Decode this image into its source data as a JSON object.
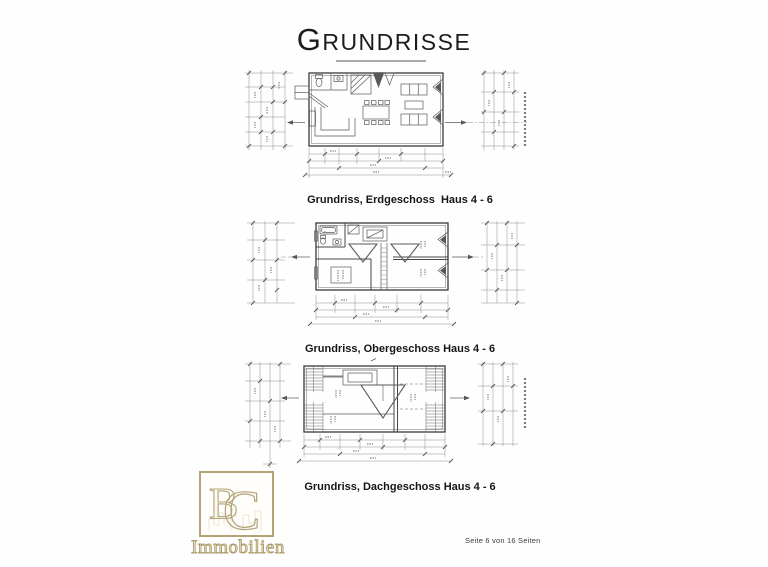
{
  "page": {
    "title": "Grundrisse",
    "page_info": "Seite 6 von 16 Seiten"
  },
  "plans": [
    {
      "caption": "Grundriss, Erdgeschoss  Haus 4 - 6"
    },
    {
      "caption": "Grundriss, Obergeschoss Haus 4 - 6"
    },
    {
      "caption": "Grundriss, Dachgeschoss Haus 4 - 6"
    }
  ],
  "logo": {
    "monogram_b": "B",
    "monogram_c": "C",
    "name": "Immobilien",
    "accent_color": "#b3a276"
  },
  "colors": {
    "drawing_line": "#555555",
    "title_underline": "#a9a9a9"
  }
}
